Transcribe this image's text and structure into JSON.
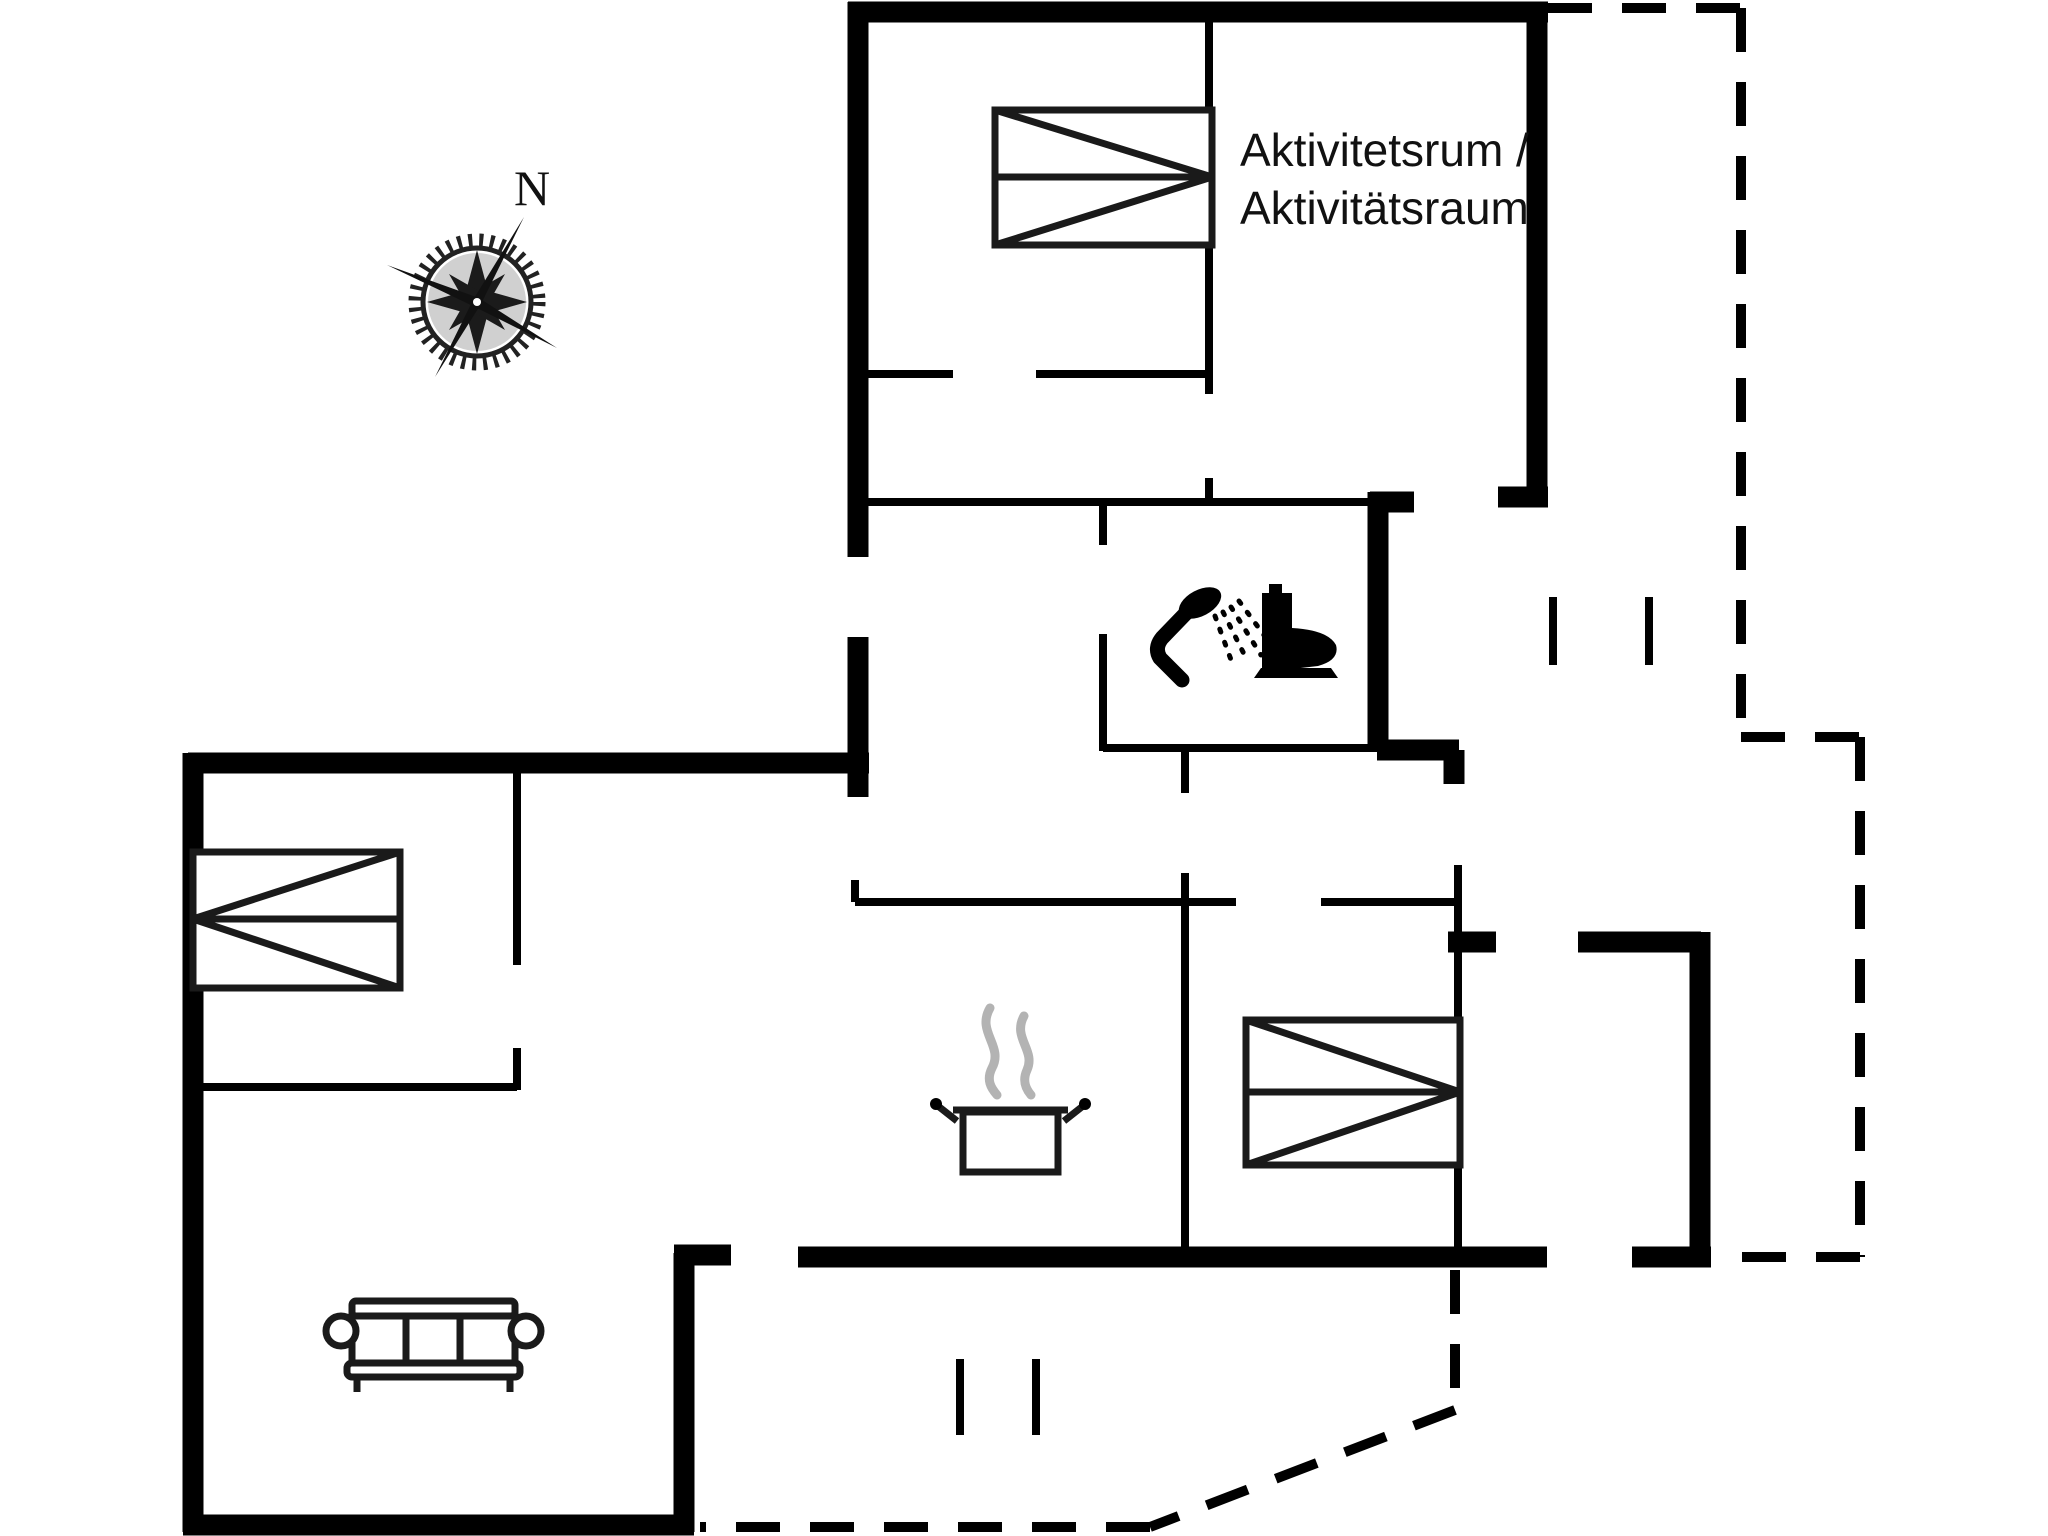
{
  "plan": {
    "type": "floor-plan",
    "background_color": "#ffffff",
    "line_color": "#000000",
    "steam_color": "#b3b3b3",
    "compass": {
      "label": "N"
    },
    "room_label": {
      "line1": "Aktivitetsrum /",
      "line2": "Aktivitätsraum"
    },
    "icons": [
      "compass-rose-icon",
      "double-bed-icon (activity room)",
      "double-bed-icon (left bedroom)",
      "double-bed-icon (right bedroom)",
      "shower-icon",
      "toilet-icon",
      "cooking-pot-icon",
      "sofa-icon"
    ]
  }
}
